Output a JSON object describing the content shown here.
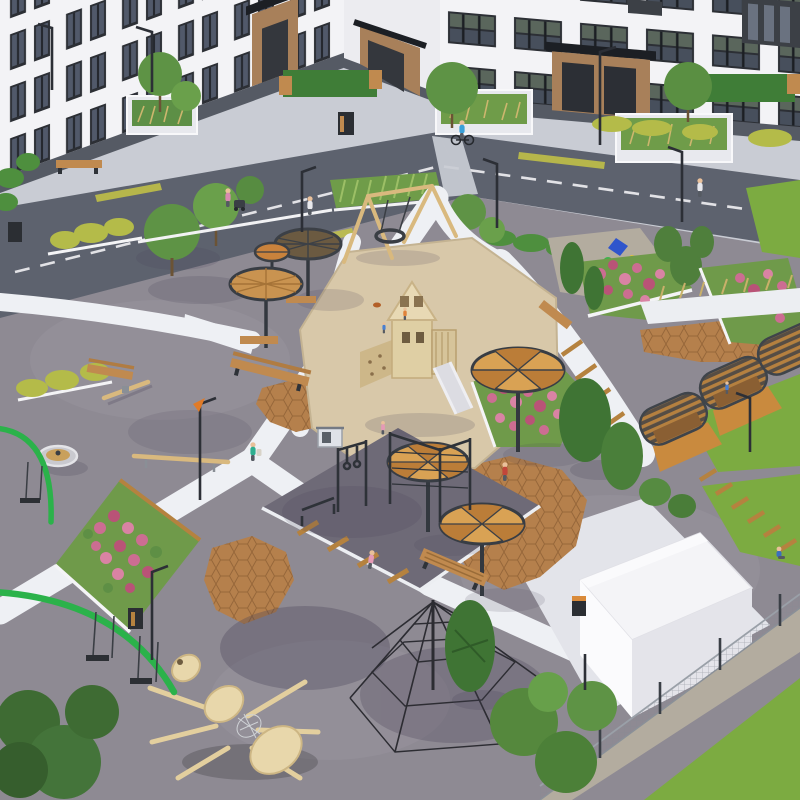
{
  "meta": {
    "type": "3d-architectural-render",
    "subject": "aerial isometric rendering of a residential courtyard playground",
    "no_visible_text": true
  },
  "palette": {
    "sidewalk": "#c9ccd4",
    "road": "#5d626e",
    "road_marking": "#e9e9ec",
    "curb_yellow": "#c6c545",
    "asphalt": "#8e8a93",
    "asphalt_light": "#9a95a0",
    "path_white": "#eef0f4",
    "apron": "#e3e4ea",
    "sand": "#d8c8a9",
    "hex_paving": "#b5804c",
    "rubber_pad": "#6e6a77",
    "lawn": "#7cab41",
    "hedge_yellow": "#b4bb49",
    "hedge_green": "#4e8f3e",
    "tree_green": "#5e9345",
    "conifer": "#3f7434",
    "flower_pink": "#cc6d92",
    "flower_deep": "#b95377",
    "bed_green": "#6f9a4a",
    "wood": "#c08a4f",
    "wood_light": "#e3cf9e",
    "canopy_orange": "#d9a254",
    "canopy_shade": "#bb7d38",
    "canopy_mesh": "#6b5a41",
    "steel_dark": "#2e3238",
    "building_wall": "#f3f3f6",
    "building_corner": "#ececf0",
    "plinth": "#555a64",
    "window_dark": "#2c2f35",
    "entrance_brown": "#a8805a",
    "pavilion_roof": "#f4f4f7",
    "pavilion_side": "#e4e4ea",
    "gravel": "#b3ac9f",
    "swing_green": "#2bb24a",
    "fence_gray": "#9aa0a8",
    "net_black": "#2c2c32"
  },
  "scene": {
    "buildings": [
      "left residential wing",
      "corner entrance section",
      "right residential wing"
    ],
    "roads": {
      "segments": 2,
      "marking": "white dashed centerline"
    },
    "playground_equipment": [
      "wooden play tower with slide in sand pit",
      "a-frame nest swing",
      "six round shade canopies with pie-slice wooden tops",
      "street workout bars with rings",
      "rope climbing pyramid",
      "giant wooden ant sculpture",
      "carousel spinner",
      "seesaw and balance beam",
      "two green arc swings",
      "wooden arch pergolas"
    ],
    "landscape": [
      "pink flower planters",
      "yellow and green hedges",
      "lawn corners",
      "gravel patch with kite decorations",
      "sand pit",
      "terracotta hex paving"
    ],
    "structures": [
      "white flat-roof pavilion",
      "mesh boundary fence",
      "street lamps"
    ],
    "people": [
      {
        "desc": "cyclist on road",
        "color": "#3aa0d8"
      },
      {
        "desc": "walker near crossing",
        "color": "#e8e8ec"
      },
      {
        "desc": "parent with stroller",
        "color": "#d88ab0"
      },
      {
        "desc": "walker with bag on path",
        "color": "#2fae8f"
      },
      {
        "desc": "person in red jacket",
        "color": "#c2463a"
      },
      {
        "desc": "running child",
        "color": "#e59ab6"
      },
      {
        "desc": "child near sand",
        "color": "#e0833a"
      },
      {
        "desc": "child in sand",
        "color": "#4a7fd0"
      },
      {
        "desc": "person sitting on lawn",
        "color": "#3a6fc0"
      },
      {
        "desc": "child at pergola",
        "color": "#4a7fd0"
      },
      {
        "desc": "walker upper right",
        "color": "#e8e8ec"
      }
    ]
  }
}
